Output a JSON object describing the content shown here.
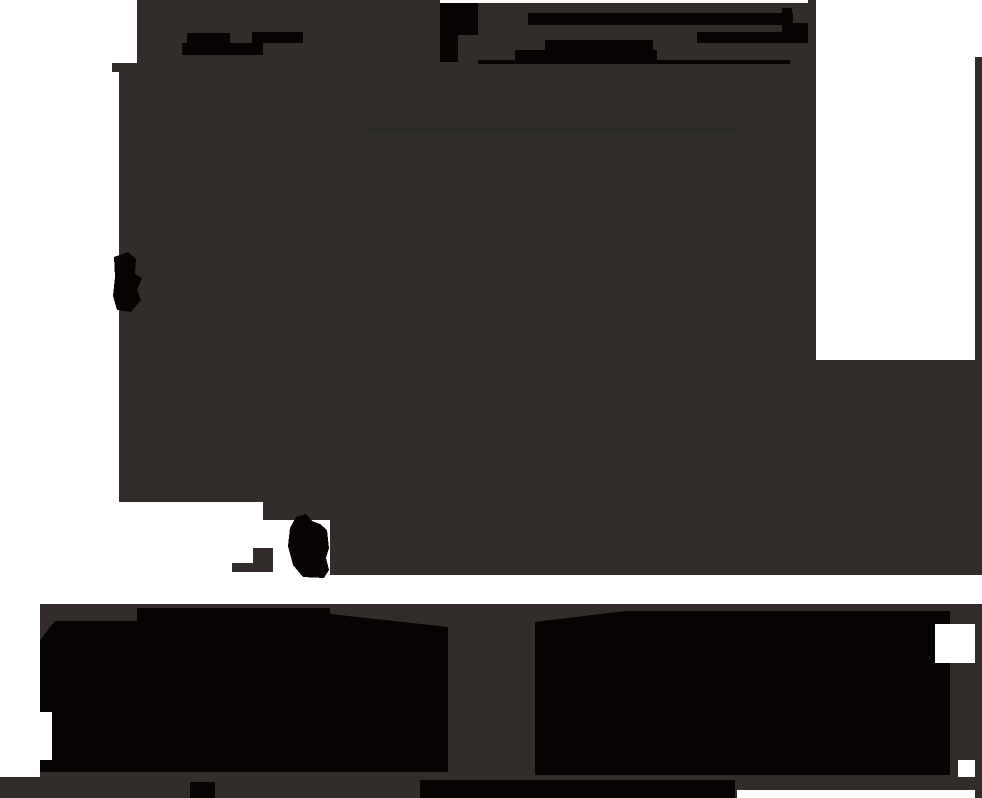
{
  "image": {
    "width": 982,
    "height": 798,
    "scene": "underexposed abstract photograph: large charcoal-gray mass covering most of the frame, pure-black smudges and bar shapes near the top, a black blob on the left edge, a small black teardrop blob lower left, white gaps at top-left corner, left edge, and a large white rectangle at top-right, a white horizontal band near the bottom above two wide black blocks separated by a gray gap, and a thin gray strip along the bottom edge"
  },
  "palette": {
    "white": "#ffffff",
    "dark": "#322c2b",
    "black": "#070302",
    "faint": "#292b29"
  },
  "shapes": [
    {
      "name": "background",
      "type": "rect",
      "fill": "white",
      "x": 0,
      "y": 0,
      "w": 982,
      "h": 798
    },
    {
      "name": "main-dark-mass",
      "type": "polygon",
      "fill": "dark",
      "points": [
        [
          137,
          0
        ],
        [
          816,
          0
        ],
        [
          816,
          360
        ],
        [
          982,
          360
        ],
        [
          982,
          575
        ],
        [
          330,
          575
        ],
        [
          330,
          520
        ],
        [
          263,
          520
        ],
        [
          263,
          502
        ],
        [
          119,
          502
        ],
        [
          119,
          72
        ],
        [
          112,
          72
        ],
        [
          112,
          63
        ],
        [
          137,
          63
        ]
      ]
    },
    {
      "name": "right-edge-strip",
      "type": "rect",
      "fill": "dark",
      "x": 975,
      "y": 57,
      "w": 7,
      "h": 303
    },
    {
      "name": "top-edge-white-sliver",
      "type": "rect",
      "fill": "white",
      "x": 440,
      "y": 0,
      "w": 368,
      "h": 3
    },
    {
      "name": "left-smudge-bar-1",
      "type": "rect",
      "fill": "black",
      "x": 187,
      "y": 33,
      "w": 43,
      "h": 10
    },
    {
      "name": "left-smudge-bar-2",
      "type": "rect",
      "fill": "black",
      "x": 252,
      "y": 32,
      "w": 51,
      "h": 11
    },
    {
      "name": "left-smudge-bar-3",
      "type": "rect",
      "fill": "black",
      "x": 182,
      "y": 43,
      "w": 81,
      "h": 12
    },
    {
      "name": "center-smudge-block-1",
      "type": "rect",
      "fill": "black",
      "x": 440,
      "y": 3,
      "w": 38,
      "h": 32
    },
    {
      "name": "center-smudge-block-2",
      "type": "rect",
      "fill": "black",
      "x": 440,
      "y": 35,
      "w": 18,
      "h": 27
    },
    {
      "name": "center-smudge-bar-1",
      "type": "rect",
      "fill": "black",
      "x": 528,
      "y": 13,
      "w": 265,
      "h": 12
    },
    {
      "name": "center-smudge-bar-2",
      "type": "rect",
      "fill": "black",
      "x": 545,
      "y": 40,
      "w": 108,
      "h": 10
    },
    {
      "name": "center-smudge-bar-3",
      "type": "rect",
      "fill": "black",
      "x": 515,
      "y": 50,
      "w": 142,
      "h": 12
    },
    {
      "name": "center-smudge-thin-bar",
      "type": "rect",
      "fill": "black",
      "x": 478,
      "y": 60,
      "w": 312,
      "h": 4
    },
    {
      "name": "right-smudge-bar-1",
      "type": "rect",
      "fill": "black",
      "x": 782,
      "y": 8,
      "w": 10,
      "h": 8
    },
    {
      "name": "right-smudge-bar-2",
      "type": "rect",
      "fill": "black",
      "x": 782,
      "y": 23,
      "w": 26,
      "h": 9
    },
    {
      "name": "right-smudge-bar-3",
      "type": "rect",
      "fill": "black",
      "x": 697,
      "y": 32,
      "w": 111,
      "h": 11
    },
    {
      "name": "faint-horizontal-line",
      "type": "rect",
      "fill": "faint",
      "x": 367,
      "y": 128,
      "w": 370,
      "h": 6
    },
    {
      "name": "left-edge-blob",
      "type": "polygon",
      "fill": "black",
      "points": [
        [
          114,
          257
        ],
        [
          128,
          252
        ],
        [
          136,
          259
        ],
        [
          135,
          274
        ],
        [
          142,
          278
        ],
        [
          137,
          290
        ],
        [
          141,
          300
        ],
        [
          131,
          312
        ],
        [
          117,
          310
        ],
        [
          113,
          296
        ],
        [
          115,
          277
        ]
      ]
    },
    {
      "name": "teardrop-blob",
      "type": "polygon",
      "fill": "black",
      "points": [
        [
          296,
          517
        ],
        [
          306,
          514
        ],
        [
          312,
          521
        ],
        [
          320,
          524
        ],
        [
          327,
          530
        ],
        [
          329,
          548
        ],
        [
          326,
          558
        ],
        [
          329,
          570
        ],
        [
          324,
          578
        ],
        [
          303,
          577
        ],
        [
          293,
          565
        ],
        [
          288,
          546
        ],
        [
          290,
          528
        ]
      ]
    },
    {
      "name": "notch-gray-block",
      "type": "rect",
      "fill": "dark",
      "x": 253,
      "y": 548,
      "w": 20,
      "h": 20
    },
    {
      "name": "notch-gray-bar",
      "type": "rect",
      "fill": "dark",
      "x": 232,
      "y": 563,
      "w": 41,
      "h": 9
    },
    {
      "name": "bottom-band-base",
      "type": "rect",
      "fill": "dark",
      "x": 40,
      "y": 604,
      "w": 942,
      "h": 173
    },
    {
      "name": "bottom-strip",
      "type": "rect",
      "fill": "dark",
      "x": 0,
      "y": 777,
      "w": 982,
      "h": 21
    },
    {
      "name": "bottom-left-black-block",
      "type": "polygon",
      "fill": "black",
      "points": [
        [
          55,
          621
        ],
        [
          137,
          621
        ],
        [
          137,
          608
        ],
        [
          330,
          608
        ],
        [
          330,
          614
        ],
        [
          448,
          627
        ],
        [
          448,
          772
        ],
        [
          40,
          772
        ],
        [
          40,
          640
        ]
      ]
    },
    {
      "name": "bottom-right-black-block",
      "type": "polygon",
      "fill": "black",
      "points": [
        [
          535,
          622
        ],
        [
          625,
          611
        ],
        [
          950,
          611
        ],
        [
          950,
          775
        ],
        [
          535,
          775
        ]
      ]
    },
    {
      "name": "white-notch-right-edge",
      "type": "rect",
      "fill": "white",
      "x": 935,
      "y": 624,
      "w": 40,
      "h": 39
    },
    {
      "name": "white-slit-bottom-left",
      "type": "rect",
      "fill": "white",
      "x": 40,
      "y": 712,
      "w": 12,
      "h": 48
    },
    {
      "name": "white-bottom-right-notch",
      "type": "rect",
      "fill": "white",
      "x": 958,
      "y": 760,
      "w": 17,
      "h": 17
    },
    {
      "name": "black-bottom-strip",
      "type": "rect",
      "fill": "black",
      "x": 420,
      "y": 780,
      "w": 315,
      "h": 18
    },
    {
      "name": "white-bottom-strip",
      "type": "rect",
      "fill": "white",
      "x": 737,
      "y": 790,
      "w": 238,
      "h": 8
    },
    {
      "name": "black-bottom-notch",
      "type": "rect",
      "fill": "black",
      "x": 190,
      "y": 782,
      "w": 25,
      "h": 16
    }
  ]
}
